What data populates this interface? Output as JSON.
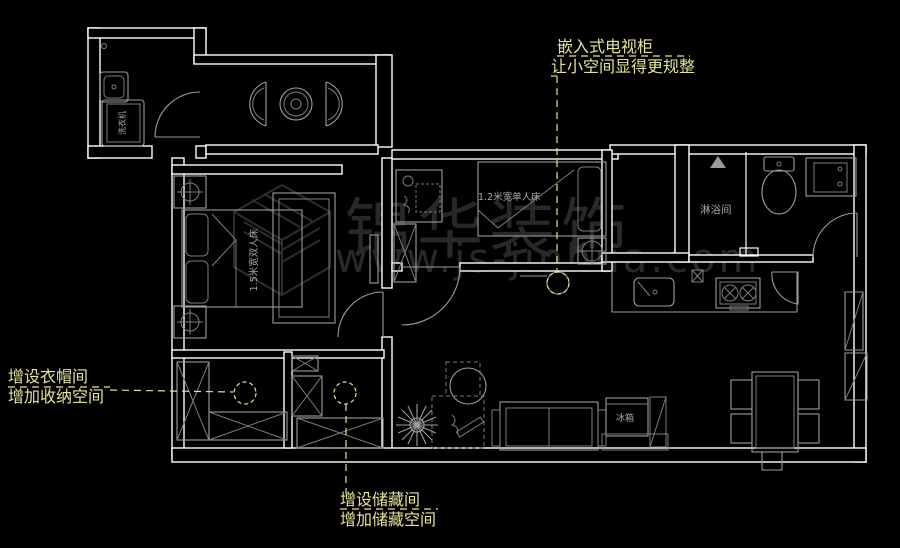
{
  "scene": {
    "background_color": "#000000",
    "wall_color": "#ffffff",
    "furniture_color": "#9c9c9c",
    "annotation_color": "#e3e39a",
    "watermark_color": "#282828"
  },
  "annotations": {
    "tv": {
      "line1": "嵌入式电视柜",
      "line2": "让小空间显得更规整"
    },
    "cloakroom": {
      "line1": "增设衣帽间",
      "line2": "增加收纳空间"
    },
    "storage": {
      "line1": "增设储藏间",
      "line2": "增加储藏空间"
    }
  },
  "room_labels": {
    "shower_room": "淋浴间",
    "fridge": "冰箱",
    "washer": "洗衣机",
    "double_bed": "1.5米宽双人床",
    "single_bed": "1.2米宽单人床"
  },
  "watermark": {
    "brand": "锦华装饰",
    "url": "www.js-jinhua.com"
  }
}
